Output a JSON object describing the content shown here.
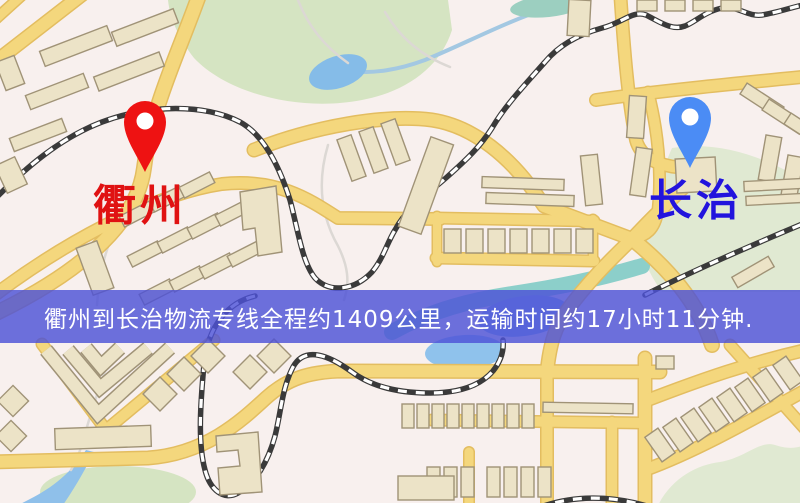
{
  "map": {
    "origin": {
      "name": "衢州",
      "pin_color": "#ee1212",
      "label_color": "#e01212",
      "pin_x": 145,
      "pin_tip_y": 172,
      "label_x": 140,
      "label_y": 207
    },
    "destination": {
      "name": "长治",
      "pin_color": "#4b8cf5",
      "label_color": "#2214dd",
      "pin_x": 690,
      "pin_tip_y": 168,
      "label_x": 696,
      "label_y": 202
    },
    "banner": {
      "text": "衢州到长治物流专线全程约1409公里，运输时间约17小时11分钟.",
      "bg_color": "rgba(77,82,215,0.82)",
      "text_color": "#ffffff",
      "top": 290,
      "height": 53
    },
    "palette": {
      "background": "#f8f0ee",
      "road_fill": "#f4d77d",
      "road_edge": "#e3bd60",
      "building_fill": "#ece3c7",
      "building_edge": "#a09377",
      "park": "#d5e4c2",
      "park_pale": "#e0e9d2",
      "water": "#8fc2ec",
      "railway_dark": "#3a3a3a",
      "railway_light": "#ffffff",
      "footpath": "#dcd8d4"
    },
    "features": {
      "parks": [
        {
          "d": "M168,0 L448,0 L452,30 C440,68 405,92 362,100 C300,112 228,94 194,58 C180,40 170,20 168,0 Z",
          "pale": false
        },
        {
          "d": "M672,148 C720,140 768,158 806,182 L806,292 L662,292 C648,272 640,255 644,240 C652,205 660,175 672,148 Z",
          "pale": true
        },
        {
          "d": "M655,512 C668,480 695,465 720,462 C745,458 760,440 775,445 C790,450 800,448 812,442 L812,512 Z",
          "pale": true
        }
      ],
      "park_ellipses": [
        [
          118,
          492,
          78,
          26,
          0
        ]
      ],
      "water_ellipses": [
        [
          338,
          72,
          30,
          16,
          -18,
          "#85bce8"
        ],
        [
          548,
          6,
          38,
          11,
          -6,
          "#9ccfc0"
        ],
        [
          524,
          316,
          46,
          20,
          -8,
          "#86b9e9"
        ],
        [
          465,
          352,
          40,
          17,
          -3,
          "#8fc2ec"
        ]
      ],
      "water_strokes": [
        {
          "d": "M548,8 C505,22 462,45 425,60 C398,70 372,74 352,71",
          "w": 4,
          "c": "#a3c8e2"
        },
        {
          "d": "M392,332 C432,310 472,300 512,294 C560,287 602,278 642,266",
          "w": 16,
          "c": "#8ccfca"
        }
      ],
      "water_fills": [
        {
          "d": "M86,450 C72,472 52,488 30,499 L5,512 L58,512 C74,490 86,468 94,452 Z",
          "c": "#8fc0ea"
        }
      ],
      "footpaths": [
        "M298,0 C308,26 324,46 348,63",
        "M385,12 C400,38 422,56 450,67",
        "M328,145 C317,182 321,216 338,246 C348,266 350,282 344,300",
        "M118,222 C104,252 99,276 97,305",
        "M112,348 C104,376 94,402 87,427 C82,447 77,460 71,470"
      ],
      "roads": [
        {
          "d": "M-10,66 L88,-10",
          "w": 12
        },
        {
          "d": "M-12,26 L30,-12",
          "w": 9
        },
        {
          "d": "M201,-10 C178,55 152,105 144,168 C136,232 62,282 -10,316",
          "w": 13
        },
        {
          "d": "M-12,300 C60,245 150,195 222,184 C278,178 310,200 338,218 L440,219",
          "w": 11
        },
        {
          "d": "M436,218 L594,221",
          "w": 10
        },
        {
          "d": "M436,258 L594,261",
          "w": 10
        },
        {
          "d": "M437,216 L437,262",
          "w": 8
        },
        {
          "d": "M593,219 L593,262",
          "w": 8
        },
        {
          "d": "M254,150 C315,126 385,114 432,120 C472,126 512,156 544,206 L632,239",
          "w": 12
        },
        {
          "d": "M632,239 C668,268 698,302 712,345",
          "w": 13
        },
        {
          "d": "M706,166 C672,198 648,222 632,239 C610,260 586,284 566,312 C556,326 550,342 547,372",
          "w": 12
        },
        {
          "d": "M620,-10 C624,50 628,100 636,140 C642,162 668,170 700,167",
          "w": 11
        },
        {
          "d": "M596,100 C650,92 730,84 812,76",
          "w": 11
        },
        {
          "d": "M648,92 C658,130 662,172 658,210 C655,230 646,236 632,239",
          "w": 10
        },
        {
          "d": "M-10,462 L148,458 C205,454 240,422 266,398 C288,378 310,372 340,371 L660,372",
          "w": 12
        },
        {
          "d": "M432,420 L645,423",
          "w": 10
        },
        {
          "d": "M547,368 L547,512",
          "w": 11
        },
        {
          "d": "M612,422 L612,512",
          "w": 10
        },
        {
          "d": "M469,452 L469,512",
          "w": 9
        },
        {
          "d": "M645,358 L645,512",
          "w": 12
        },
        {
          "d": "M648,400 C700,380 750,362 815,348",
          "w": 11
        },
        {
          "d": "M645,470 C700,450 760,415 815,385",
          "w": 11
        },
        {
          "d": "M730,345 L815,440",
          "w": 10
        },
        {
          "d": "M42,344 L106,430 L214,340",
          "w": 10
        }
      ],
      "railways": [
        "M-8,202 C25,168 60,138 102,122 C150,104 205,104 240,122 C262,134 278,162 290,200 C298,230 302,262 315,278 C330,294 355,290 372,272 C383,259 387,243 395,230 C408,206 428,194 447,177 C466,160 480,147 492,128 C505,106 522,88 545,62 C560,44 580,34 602,28 C622,23 633,10 646,15 C660,22 672,31 685,26 C697,21 704,12 722,8 C737,5 747,17 762,15 C780,12 795,6 812,3",
        "M255,296 C228,302 208,326 204,364 C200,408 198,444 205,470 C210,490 224,501 238,493 C255,484 268,462 275,436 C281,412 282,388 293,367 C305,345 330,356 352,372 C372,387 400,393 430,393 C459,393 480,386 493,371 C501,361 504,350 503,340",
        "M645,295 C688,273 740,250 812,220",
        "M538,508 C572,495 612,495 650,507"
      ],
      "building_rects": [
        [
          40,
          38,
          72,
          16,
          -21
        ],
        [
          112,
          20,
          66,
          15,
          -21
        ],
        [
          26,
          84,
          62,
          15,
          -21
        ],
        [
          94,
          64,
          70,
          15,
          -21
        ],
        [
          10,
          128,
          56,
          14,
          -21
        ],
        [
          0,
          58,
          20,
          30,
          -21
        ],
        [
          0,
          160,
          22,
          30,
          -25
        ],
        [
          120,
          208,
          34,
          12,
          -27
        ],
        [
          150,
          193,
          34,
          12,
          -27
        ],
        [
          180,
          179,
          34,
          12,
          -27
        ],
        [
          128,
          248,
          34,
          12,
          -27
        ],
        [
          158,
          234,
          34,
          12,
          -27
        ],
        [
          188,
          220,
          34,
          12,
          -27
        ],
        [
          216,
          207,
          34,
          12,
          -27
        ],
        [
          140,
          286,
          34,
          12,
          -27
        ],
        [
          170,
          273,
          34,
          12,
          -27
        ],
        [
          200,
          260,
          34,
          12,
          -27
        ],
        [
          228,
          248,
          34,
          12,
          -27
        ],
        [
          84,
          243,
          22,
          50,
          -20
        ],
        [
          344,
          136,
          15,
          44,
          -20
        ],
        [
          366,
          128,
          15,
          44,
          -20
        ],
        [
          388,
          120,
          15,
          44,
          -20
        ],
        [
          414,
          138,
          24,
          95,
          20
        ],
        [
          482,
          178,
          82,
          11,
          2
        ],
        [
          486,
          194,
          88,
          11,
          2
        ],
        [
          583,
          155,
          17,
          50,
          -6
        ],
        [
          568,
          0,
          22,
          36,
          3
        ],
        [
          444,
          229,
          17,
          24,
          0
        ],
        [
          466,
          229,
          17,
          24,
          0
        ],
        [
          488,
          229,
          17,
          24,
          0
        ],
        [
          510,
          229,
          17,
          24,
          0
        ],
        [
          532,
          229,
          17,
          24,
          0
        ],
        [
          554,
          229,
          17,
          24,
          0
        ],
        [
          576,
          229,
          17,
          24,
          0
        ],
        [
          637,
          0,
          20,
          11,
          0
        ],
        [
          665,
          0,
          20,
          11,
          0
        ],
        [
          693,
          0,
          20,
          11,
          0
        ],
        [
          721,
          0,
          20,
          11,
          0
        ],
        [
          740,
          94,
          44,
          13,
          33
        ],
        [
          762,
          110,
          44,
          13,
          33
        ],
        [
          784,
          124,
          44,
          13,
          33
        ],
        [
          628,
          96,
          17,
          42,
          4
        ],
        [
          633,
          148,
          16,
          48,
          8
        ],
        [
          676,
          158,
          40,
          34,
          -3
        ],
        [
          762,
          136,
          16,
          45,
          10
        ],
        [
          784,
          156,
          16,
          45,
          10
        ],
        [
          744,
          180,
          58,
          10,
          -3
        ],
        [
          746,
          195,
          55,
          9,
          -3
        ],
        [
          732,
          266,
          42,
          12,
          -30
        ],
        [
          148,
          382,
          24,
          24,
          45
        ],
        [
          172,
          362,
          24,
          24,
          45
        ],
        [
          196,
          344,
          24,
          24,
          45
        ],
        [
          238,
          360,
          24,
          24,
          45
        ],
        [
          262,
          344,
          24,
          24,
          45
        ],
        [
          2,
          390,
          22,
          22,
          45
        ],
        [
          0,
          425,
          22,
          22,
          45
        ],
        [
          55,
          427,
          96,
          21,
          -2
        ],
        [
          402,
          404,
          12,
          24,
          0
        ],
        [
          417,
          404,
          12,
          24,
          0
        ],
        [
          432,
          404,
          12,
          24,
          0
        ],
        [
          447,
          404,
          12,
          24,
          0
        ],
        [
          462,
          404,
          12,
          24,
          0
        ],
        [
          477,
          404,
          12,
          24,
          0
        ],
        [
          492,
          404,
          12,
          24,
          0
        ],
        [
          507,
          404,
          12,
          24,
          0
        ],
        [
          522,
          404,
          12,
          24,
          0
        ],
        [
          543,
          403,
          90,
          10,
          1
        ],
        [
          427,
          467,
          13,
          30,
          0
        ],
        [
          444,
          467,
          13,
          30,
          0
        ],
        [
          461,
          467,
          13,
          30,
          0
        ],
        [
          487,
          467,
          13,
          30,
          0
        ],
        [
          504,
          467,
          13,
          30,
          0
        ],
        [
          521,
          467,
          13,
          30,
          0
        ],
        [
          538,
          467,
          13,
          30,
          0
        ],
        [
          398,
          476,
          56,
          24,
          0
        ],
        [
          656,
          356,
          18,
          13,
          0
        ],
        [
          652,
          430,
          16,
          30,
          -35
        ],
        [
          670,
          420,
          16,
          30,
          -35
        ],
        [
          688,
          410,
          16,
          30,
          -35
        ],
        [
          706,
          400,
          16,
          30,
          -35
        ],
        [
          724,
          390,
          16,
          30,
          -35
        ],
        [
          742,
          380,
          16,
          30,
          -35
        ],
        [
          760,
          370,
          16,
          30,
          -35
        ],
        [
          780,
          358,
          16,
          30,
          -35
        ]
      ],
      "building_polys": [
        "240,192 276,186 282,252 258,256 255,228 243,230",
        "216,436 258,432 262,492 220,495 218,468 240,466 238,450 217,452"
      ],
      "chevrons": [
        "M46,350 L98,414 L170,348",
        "M68,350 L100,388 L148,348",
        "M86,348 L101,366 L120,348"
      ]
    }
  }
}
